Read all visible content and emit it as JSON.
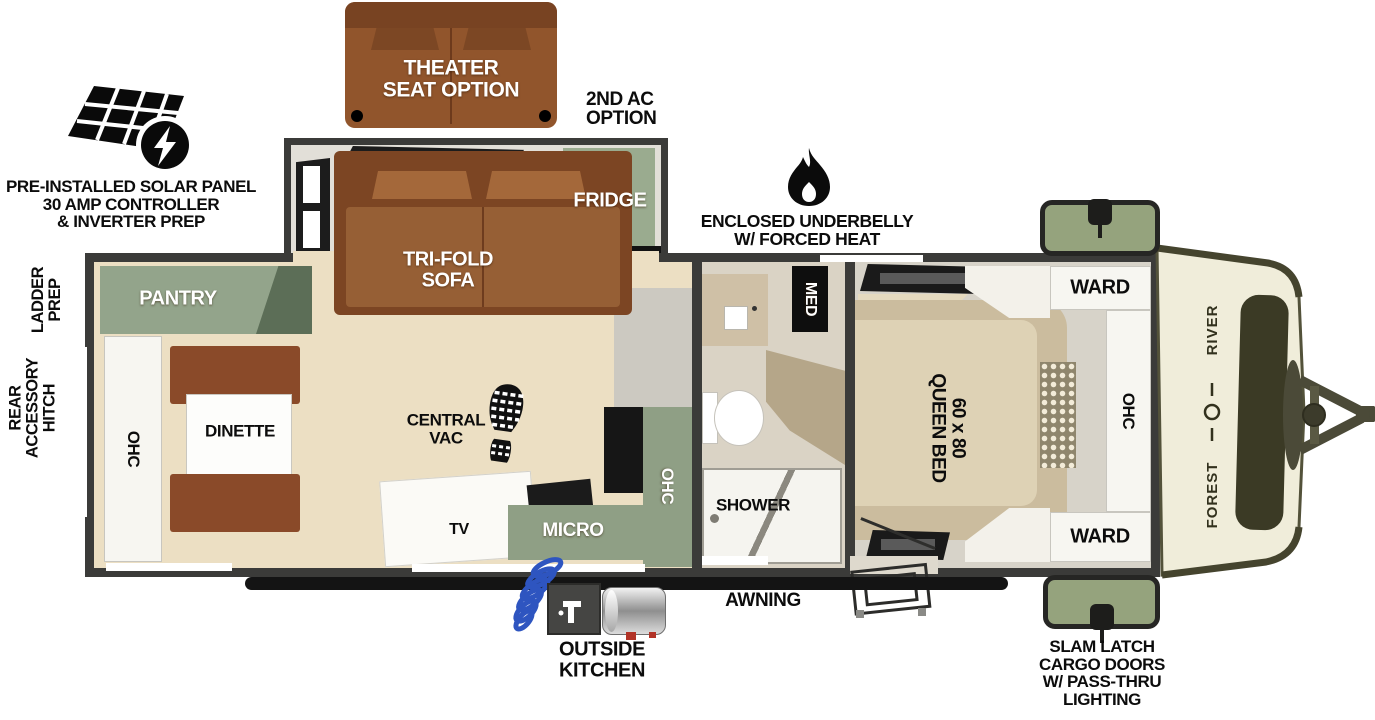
{
  "callouts": {
    "theater_seat": "THEATER\nSEAT OPTION",
    "second_ac": "2ND AC\nOPTION",
    "solar": "PRE-INSTALLED SOLAR PANEL\n30 AMP CONTROLLER\n& INVERTER PREP",
    "underbelly": "ENCLOSED UNDERBELLY\nW/ FORCED HEAT",
    "ladder_prep": "LADDER\nPREP",
    "rear_accessory_hitch": "REAR\nACCESSORY\nHITCH",
    "awning": "AWNING",
    "outside_kitchen": "OUTSIDE\nKITCHEN",
    "slam_latch": "SLAM LATCH\nCARGO DOORS\nW/ PASS-THRU\nLIGHTING"
  },
  "living_area": {
    "pantry": "PANTRY",
    "ohc_rear": "OHC",
    "dinette": "DINETTE",
    "central_vac": "CENTRAL\nVAC",
    "tv": "TV",
    "micro": "MICRO",
    "ohc_kitchen": "OHC",
    "tri_fold_sofa": "TRI-FOLD\nSOFA",
    "fridge": "FRIDGE"
  },
  "bathroom": {
    "med": "MED",
    "shower": "SHOWER"
  },
  "bedroom": {
    "queen_bed": "60 x 80\nQUEEN BED",
    "ward_front": "WARD",
    "ward_rear": "WARD",
    "ohc": "OHC"
  },
  "brand": {
    "word1": "FOREST",
    "word2": "RIVER"
  },
  "colors": {
    "wall": "#3b3b39",
    "floor_wood": "#ecdfc3",
    "cabinet_green": "#8f9f85",
    "sofa_brown": "#7c4523",
    "cargo_green": "#95a37d",
    "front_cap": "#f0edda",
    "hose_blue": "#2e55c0"
  }
}
